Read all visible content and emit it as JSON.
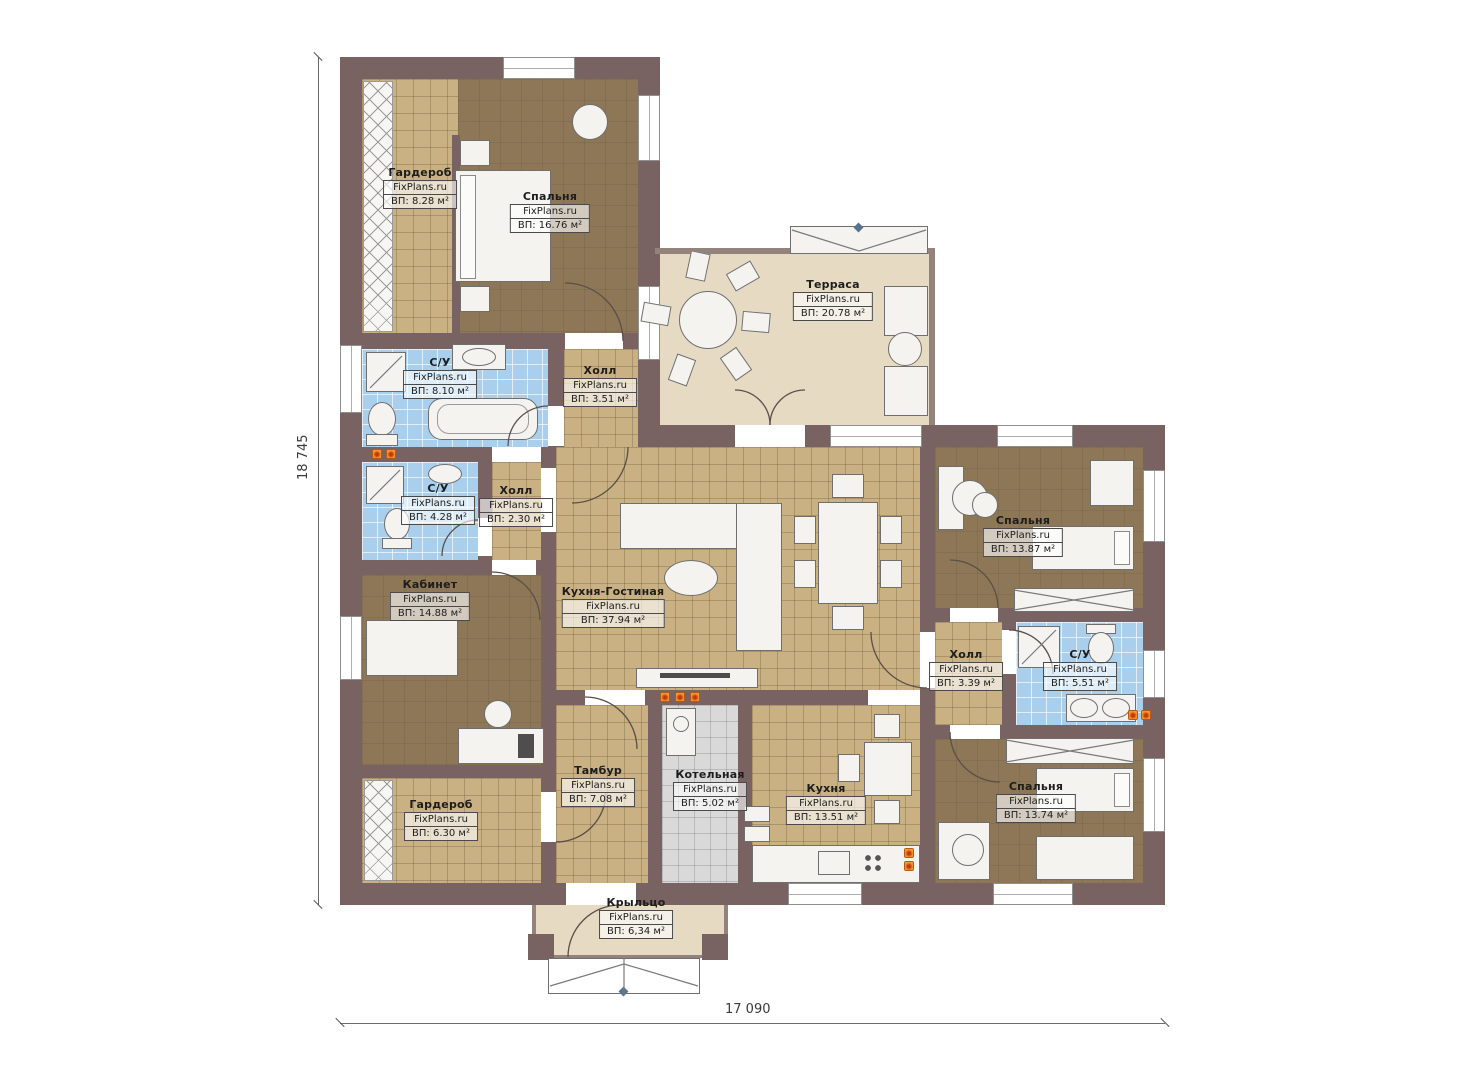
{
  "plan": {
    "watermark": "FixPlans.ru",
    "dimensions": {
      "vertical": "18 745",
      "horizontal": "17 090"
    },
    "colors": {
      "wall": "#786362",
      "floor_brown": "#8d7757",
      "tile_tan": "#c9b183",
      "tile_blue": "#aacfec",
      "tile_gray": "#d9d9d9",
      "terrace_beige": "#e6dac3",
      "flame_orange": "#f78b1f"
    },
    "rooms": [
      {
        "name": "Гардероб",
        "area": "ВП: 8.28 м²"
      },
      {
        "name": "Спальня",
        "area": "ВП: 16.76 м²"
      },
      {
        "name": "Терраса",
        "area": "ВП: 20.78 м²"
      },
      {
        "name": "С/У",
        "area": "ВП: 8.10 м²"
      },
      {
        "name": "Холл",
        "area": "ВП: 3.51 м²"
      },
      {
        "name": "С/У",
        "area": "ВП: 4.28 м²"
      },
      {
        "name": "Холл",
        "area": "ВП: 2.30 м²"
      },
      {
        "name": "Кабинет",
        "area": "ВП: 14.88 м²"
      },
      {
        "name": "Кухня-Гостиная",
        "area": "ВП: 37.94 м²"
      },
      {
        "name": "Спальня",
        "area": "ВП: 13.87 м²"
      },
      {
        "name": "Холл",
        "area": "ВП: 3.39 м²"
      },
      {
        "name": "С/У",
        "area": "ВП: 5.51 м²"
      },
      {
        "name": "Тамбур",
        "area": "ВП: 7.08 м²"
      },
      {
        "name": "Котельная",
        "area": "ВП: 5.02 м²"
      },
      {
        "name": "Кухня",
        "area": "ВП: 13.51 м²"
      },
      {
        "name": "Спальня",
        "area": "ВП: 13.74 м²"
      },
      {
        "name": "Гардероб",
        "area": "ВП: 6.30 м²"
      },
      {
        "name": "Крыльцо",
        "area": "ВП: 6,34 м²"
      }
    ]
  }
}
